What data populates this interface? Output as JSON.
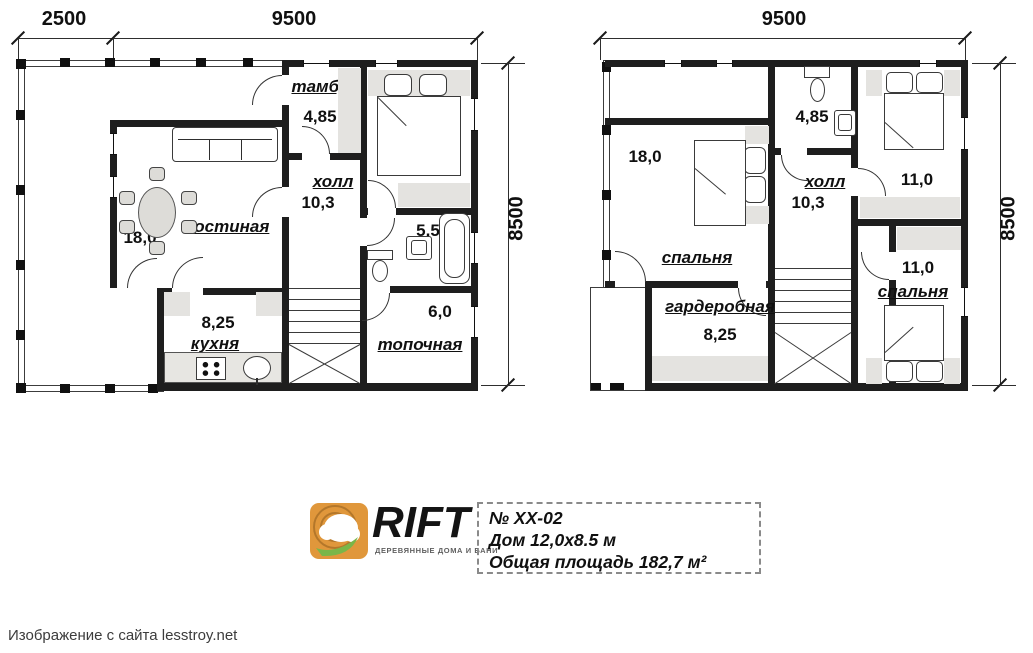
{
  "floor1": {
    "dims": {
      "left": "2500",
      "top": "9500",
      "right": "8500"
    },
    "rooms": [
      {
        "name": "тамбур",
        "area": "4,85"
      },
      {
        "name": "спальня",
        "area": "9,45"
      },
      {
        "name": "холл",
        "area": "10,3"
      },
      {
        "name": "гостиная",
        "area": "18,0"
      },
      {
        "name": "кухня",
        "area": "8,25"
      },
      {
        "area": "5,5"
      },
      {
        "name": "топочная",
        "area": "6,0"
      }
    ]
  },
  "floor2": {
    "dims": {
      "top": "9500",
      "right": "8500"
    },
    "rooms": [
      {
        "name": "спальня",
        "area": "18,0"
      },
      {
        "area": "4,85"
      },
      {
        "name": "холл",
        "area": "10,3"
      },
      {
        "name": "спальня",
        "area": "11,0"
      },
      {
        "name": "гардеробная",
        "area": "8,25"
      },
      {
        "name": "спальня",
        "area": "11,0"
      }
    ]
  },
  "logo": {
    "brand": "RIFT",
    "tagline": "ДЕРЕВЯННЫЕ ДОМА И БАНИ"
  },
  "info": {
    "number": "№ XX-02",
    "house": "Дом 12,0х8.5 м",
    "total": "Общая площадь 182,7 м²"
  },
  "caption": "Изображение с сайта lesstroy.net",
  "colors": {
    "wall": "#1e1e1e",
    "furniture_gray": "#e4e3e0",
    "logo_orange": "#e0973b",
    "logo_green": "#7ab648"
  }
}
